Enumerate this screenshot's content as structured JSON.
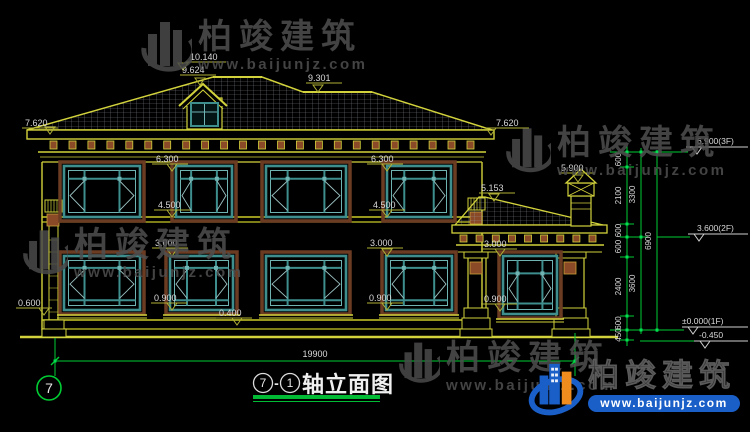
{
  "meta": {
    "axis_start": "7",
    "separator": "-",
    "axis_end": "1",
    "title_text": "轴立面图",
    "axis_bubble": "7"
  },
  "watermark": {
    "brand": "柏竣建筑",
    "url": "www.baijunjz.com"
  },
  "logo": {
    "brand": "柏竣建筑",
    "url": "www.baijunjz.com"
  },
  "levels": {
    "ridge_main": "10.140",
    "dormer_ridge": "9.624",
    "ridge_secondary": "9.301",
    "eave_main": "7.620",
    "chimney_top": "5.900",
    "porch_eave": "5.153",
    "win2f_head": "6.300",
    "win2f_sill": "4.500",
    "win1f_head": "3.000",
    "win1f_sill": "0.900",
    "plinth_top": "0.400",
    "base_left": "0.600"
  },
  "overall_width": "19900",
  "right_chain": {
    "segments": [
      "600",
      "2100",
      "600",
      "600",
      "2400",
      "600",
      "450"
    ],
    "subtotals": [
      "3300",
      "3600"
    ],
    "total": "6900",
    "flags": {
      "f3": "6.900(3F)",
      "f2": "3.600(2F)",
      "f1": "±0.000(1F)",
      "ground": "-0.450"
    }
  },
  "colors": {
    "line_yellow": "#d2d23c",
    "dim_green": "#00cc33",
    "window_teal": "#3e8e8e",
    "window_teal_light": "#6fb3b3",
    "surround_brown": "#6b3b22",
    "dentil_brown": "#8a4a28",
    "text_white": "#d9d9d9",
    "logo_blue": "#1a5fc8",
    "logo_orange": "#f08c1e"
  }
}
